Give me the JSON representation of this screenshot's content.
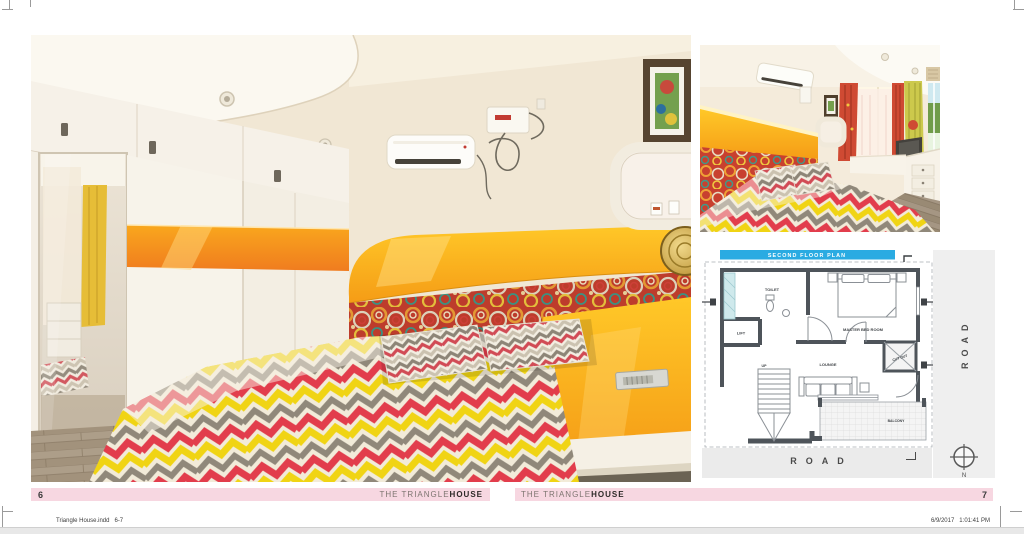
{
  "footer": {
    "series_title_regular": "THE TRIANGLE",
    "series_title_bold": "HOUSE",
    "left_page_number": "6",
    "right_page_number": "7"
  },
  "print_slug": {
    "left": "Triangle House.indd   6-7",
    "right": "6/9/2017   1:01:41 PM"
  },
  "floor_plan": {
    "title": "SECOND FLOOR PLAN",
    "labels": {
      "toilet": "TOILET",
      "lift": "LIFT",
      "master_bedroom": "MASTER BED ROOM",
      "lounge": "LOUNGE",
      "up": "UP",
      "cut_out": "CUT OUT",
      "balcony": "BALCONY"
    },
    "road_bottom": "ROAD",
    "road_side": "ROAD",
    "compass_north": "N"
  },
  "colors": {
    "footer_pink": "#f7d7e1",
    "plan_header_blue": "#2aabe2",
    "accent_yellow": "#ffbf1f",
    "accent_orange": "#f58220",
    "fabric_red": "#e23d4c",
    "fabric_yellow": "#f0d414",
    "wall_cream": "#f1e7d4",
    "plan_wall_gray": "#4e545a"
  }
}
